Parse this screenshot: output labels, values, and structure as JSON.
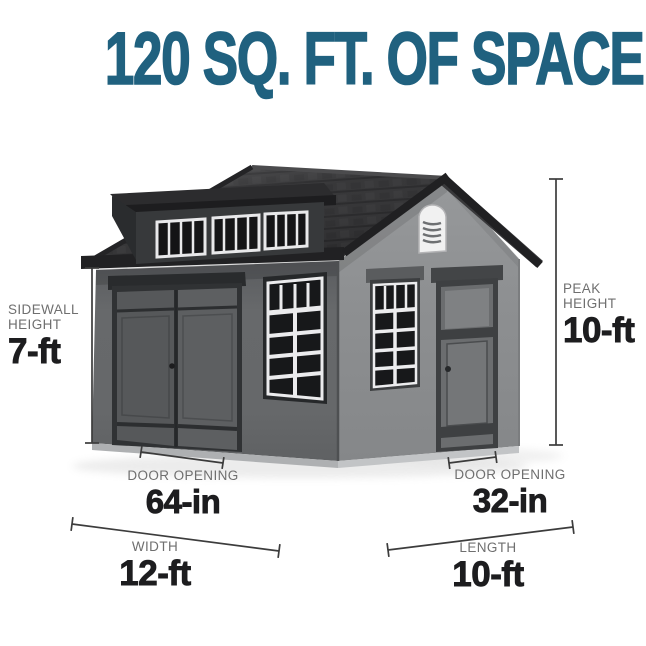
{
  "title": {
    "text": "120 SQ. FT. OF SPACE",
    "color": "#20617f"
  },
  "annotations": {
    "sidewall_height": {
      "label": [
        "SIDEWALL",
        "HEIGHT"
      ],
      "value": "7-ft"
    },
    "peak_height": {
      "label": [
        "PEAK",
        "HEIGHT"
      ],
      "value": "10-ft"
    },
    "door_opening_left": {
      "label": "DOOR OPENING",
      "value": "64-in"
    },
    "door_opening_right": {
      "label": "DOOR OPENING",
      "value": "32-in"
    },
    "width": {
      "label": "WIDTH",
      "value": "12-ft"
    },
    "length": {
      "label": "LENGTH",
      "value": "10-ft"
    }
  },
  "illustration": {
    "description": "Gray gable-roof storage shed viewed from a corner: double doors and a gridded window on the side wall; gridded window, single door and white louvered gable vent on the end wall; long shed dormer with three divided windows on the roof",
    "colors": {
      "wall_side": "#646668",
      "wall_end": "#8a8c8e",
      "roof": "#2c2c2e",
      "trim": "#232325",
      "window_grid": "#ececee",
      "vent": "#f1f1f1",
      "label_gray": "#6f6f6f",
      "value_black": "#1d1d1f",
      "dimension_line": "#3c3c3c"
    }
  }
}
